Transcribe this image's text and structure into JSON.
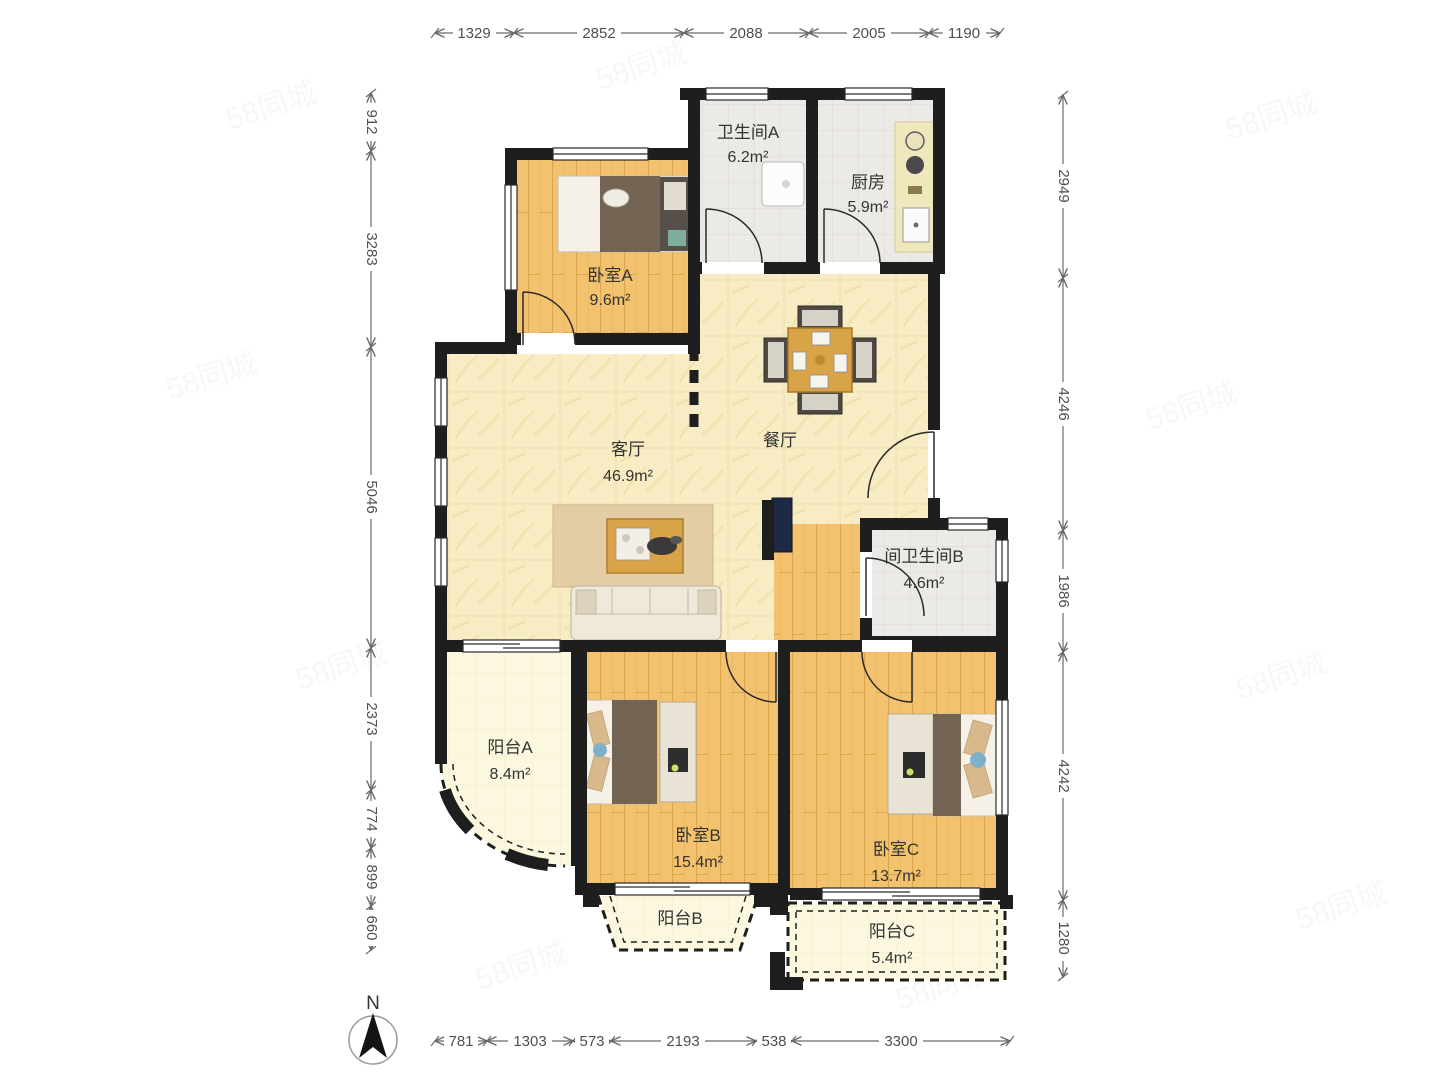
{
  "watermark_text": "58同城",
  "compass_label": "N",
  "rooms": {
    "bathroom_a": {
      "name": "卫生间A",
      "area": "6.2m²"
    },
    "kitchen": {
      "name": "厨房",
      "area": "5.9m²"
    },
    "bedroom_a": {
      "name": "卧室A",
      "area": "9.6m²"
    },
    "living_room": {
      "name": "客厅",
      "area": "46.9m²"
    },
    "dining_room": {
      "name": "餐厅"
    },
    "bathroom_b": {
      "name": "间卫生间B",
      "area": "4.6m²"
    },
    "balcony_a": {
      "name": "阳台A",
      "area": "8.4m²"
    },
    "bedroom_b": {
      "name": "卧室B",
      "area": "15.4m²"
    },
    "bedroom_c": {
      "name": "卧室C",
      "area": "13.7m²"
    },
    "balcony_b": {
      "name": "阳台B"
    },
    "balcony_c": {
      "name": "阳台C",
      "area": "5.4m²"
    }
  },
  "dimensions_mm": {
    "top": [
      "1329",
      "2852",
      "2088",
      "2005",
      "1190"
    ],
    "left": [
      "912",
      "3283",
      "5046",
      "2373",
      "774",
      "899",
      "660"
    ],
    "right": [
      "2949",
      "4246",
      "1986",
      "4242",
      "1280"
    ],
    "bottom": [
      "781",
      "1303",
      "573",
      "2193",
      "538",
      "3300"
    ]
  },
  "colors": {
    "wall": "#1e1e1e",
    "wood_floor": "#f3c26e",
    "tile_floor": "#eceae6",
    "marble_floor": "#f7ecc4",
    "balcony_floor": "#fbf8df",
    "dimension_text": "#4f4f4f",
    "tv_accent": "#1d2a45"
  }
}
